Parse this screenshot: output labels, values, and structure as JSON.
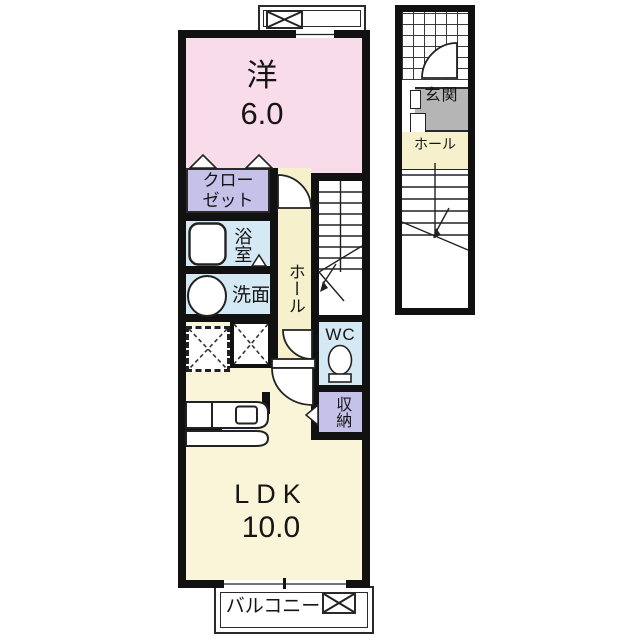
{
  "rooms": {
    "western": {
      "label": "洋",
      "area": "6.0"
    },
    "closet": {
      "label": "クローゼット"
    },
    "bath": {
      "label": "浴室"
    },
    "wash": {
      "label": "洗面"
    },
    "hall": {
      "label": "ホール"
    },
    "wc": {
      "label": "WC"
    },
    "storage": {
      "label": "収納"
    },
    "ldk": {
      "label": "LDK",
      "area": "10.0"
    },
    "balcony": {
      "label": "バルコニー"
    },
    "genkan": {
      "label": "玄関"
    },
    "entrance_hall": {
      "label": "ホール"
    }
  },
  "colors": {
    "wall": "#111111",
    "western_room": "#f9dce9",
    "closet_storage": "#c5c1e9",
    "wet_area": "#d5e9f4",
    "hall": "#f6f0cd",
    "ldk": "#faf5d9",
    "genkan": "#b5b5b5",
    "outline": "#222222"
  }
}
